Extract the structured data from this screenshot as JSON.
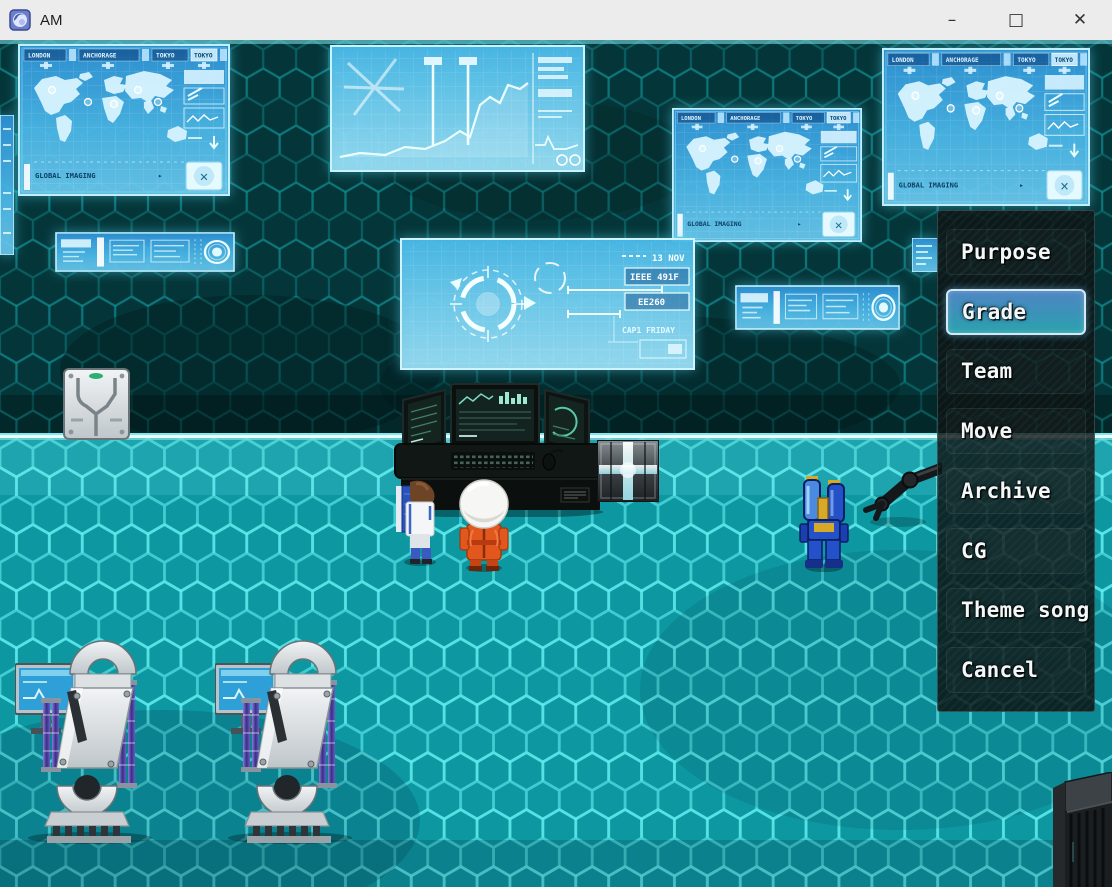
{
  "window": {
    "title": "AM",
    "minimize_glyph": "–",
    "maximize_glyph": "□",
    "close_glyph": "✕"
  },
  "menu": {
    "selected_index": 1,
    "items": [
      {
        "label": "Purpose",
        "selected": false
      },
      {
        "label": "Grade",
        "selected": true
      },
      {
        "label": "Team",
        "selected": false
      },
      {
        "label": "Move",
        "selected": false
      },
      {
        "label": "Archive",
        "selected": false
      },
      {
        "label": "CG",
        "selected": false
      },
      {
        "label": "Theme song",
        "selected": false
      },
      {
        "label": "Cancel",
        "selected": false
      }
    ]
  },
  "holograms": {
    "map_screen": {
      "city_tabs": [
        "LONDON",
        "ANCHORAGE",
        "TOKYO",
        "TOKYO"
      ],
      "footer": "GLOBAL IMAGING",
      "footer_arrow": "▸",
      "close_glyph": "✕"
    },
    "center_panel": {
      "date_text": "13 NOV",
      "code_1": "IEEE 491F",
      "code_2": "EE260",
      "code_3": "CAP1 FRIDAY"
    }
  },
  "colors": {
    "titlebar_bg": "#ececec",
    "wall_base": "#043639",
    "floor_base": "#0d97a1",
    "floor_hex_line": "#62f0f2",
    "hologram_blue": "#3fa7e0",
    "hologram_border": "#bff0ff",
    "menu_bg": "rgba(14,20,20,0.82)",
    "menu_selected_top": "#4e86c4",
    "menu_selected_bottom": "#2aa3ad"
  }
}
